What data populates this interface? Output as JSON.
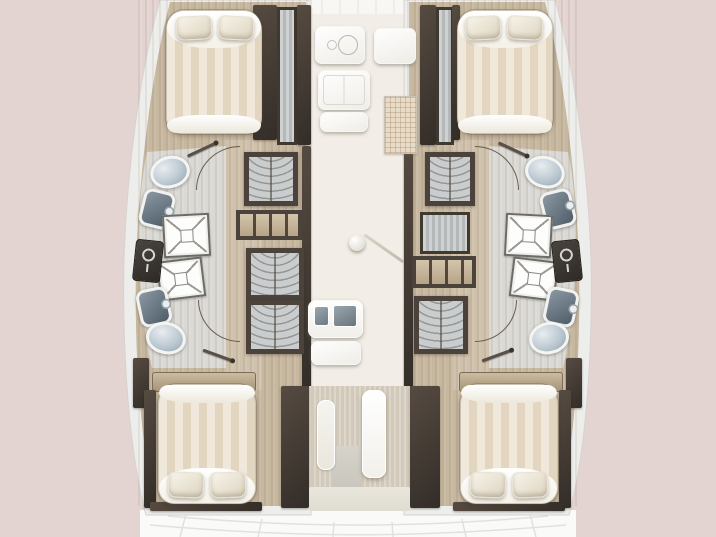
{
  "title": "Catamaran 4-cabin interior layout floor plan (top view)",
  "canvas": {
    "width": 716,
    "height": 537,
    "background": "#e3d4d2"
  },
  "palette": {
    "background": "#e3d4d2",
    "hull_rim": "#edeeec",
    "hull_floor": "#c6b79f",
    "corridor_floor": "#cfc2ac",
    "bathroom_floor": "#dad9d5",
    "saloon_floor": "#f2eee7",
    "cockpit": "#fafaf8",
    "dark_wall": "#463e37",
    "wood_trim": "#b49e83",
    "bed_stripe_a": "#f0e8da",
    "bed_stripe_b": "#e2d6c1",
    "ceramic_blue": "#a7b8c4",
    "basin_slate": "#5c6b77",
    "mat": "#e8dcc8"
  },
  "rooms": [
    {
      "n": "port-forward-cabin",
      "x": 140,
      "y": 0,
      "w": 170,
      "h": 146
    },
    {
      "n": "port-bathroom",
      "x": 128,
      "y": 146,
      "w": 110,
      "h": 222
    },
    {
      "n": "port-aft-cabin",
      "x": 138,
      "y": 368,
      "w": 176,
      "h": 142
    },
    {
      "n": "starboard-forward-cabin",
      "x": 405,
      "y": 0,
      "w": 170,
      "h": 146
    },
    {
      "n": "starboard-bathroom",
      "x": 478,
      "y": 146,
      "w": 110,
      "h": 222
    },
    {
      "n": "starboard-aft-cabin",
      "x": 400,
      "y": 368,
      "w": 176,
      "h": 142
    },
    {
      "n": "saloon-galley",
      "x": 306,
      "y": 0,
      "w": 103,
      "h": 386
    },
    {
      "n": "companionway",
      "x": 281,
      "y": 386,
      "w": 159,
      "h": 126
    },
    {
      "n": "cockpit",
      "x": 140,
      "y": 510,
      "w": 436,
      "h": 27
    }
  ],
  "fixtures": [
    {
      "t": "grain",
      "n": "port-floor-grain",
      "x": 138,
      "y": 0,
      "w": 170,
      "h": 506
    },
    {
      "t": "grain",
      "n": "stbd-floor-grain",
      "x": 407,
      "y": 0,
      "w": 170,
      "h": 506
    },
    {
      "t": "dark-panel",
      "n": "port-fwd-inner-wall",
      "x": 253,
      "y": 5,
      "w": 24,
      "h": 135
    },
    {
      "t": "locker-stripes",
      "n": "port-fwd-hanging-locker",
      "x": 277,
      "y": 7,
      "w": 20,
      "h": 138
    },
    {
      "t": "dark-panel",
      "n": "port-saloon-partition",
      "x": 297,
      "y": 5,
      "w": 14,
      "h": 140
    },
    {
      "t": "dark-panel",
      "n": "stbd-saloon-partition",
      "x": 420,
      "y": 5,
      "w": 16,
      "h": 140
    },
    {
      "t": "locker-stripes",
      "n": "stbd-fwd-hanging-locker",
      "x": 436,
      "y": 7,
      "w": 18,
      "h": 138
    },
    {
      "t": "dark-panel",
      "n": "stbd-fwd-inner-wall",
      "x": 452,
      "y": 5,
      "w": 8,
      "h": 135
    },
    {
      "t": "dark-panel",
      "n": "port-mid-partition",
      "x": 302,
      "y": 146,
      "w": 9,
      "h": 246
    },
    {
      "t": "dark-panel",
      "n": "stbd-mid-partition",
      "x": 404,
      "y": 146,
      "w": 9,
      "h": 246
    },
    {
      "t": "wardrobe",
      "n": "port-fwd-wardrobe",
      "x": 244,
      "y": 152,
      "w": 54,
      "h": 54
    },
    {
      "t": "shelves",
      "n": "port-shelf-unit",
      "x": 236,
      "y": 210,
      "w": 66,
      "h": 30
    },
    {
      "t": "wardrobe",
      "n": "port-mid-wardrobe",
      "x": 246,
      "y": 248,
      "w": 58,
      "h": 52
    },
    {
      "t": "wardrobe",
      "n": "port-aft-wardrobe",
      "x": 246,
      "y": 300,
      "w": 58,
      "h": 54
    },
    {
      "t": "wardrobe",
      "n": "stbd-fwd-wardrobe",
      "x": 425,
      "y": 152,
      "w": 50,
      "h": 54
    },
    {
      "t": "locker-stripes",
      "n": "stbd-mid-locker",
      "x": 420,
      "y": 212,
      "w": 50,
      "h": 42
    },
    {
      "t": "shelves",
      "n": "stbd-shelf-unit",
      "x": 412,
      "y": 256,
      "w": 64,
      "h": 32
    },
    {
      "t": "wardrobe",
      "n": "stbd-aft-wardrobe",
      "x": 414,
      "y": 296,
      "w": 54,
      "h": 58
    },
    {
      "t": "dark-panel",
      "n": "port-aft-outboard-wall",
      "x": 133,
      "y": 358,
      "w": 16,
      "h": 50
    },
    {
      "t": "dark-panel",
      "n": "stbd-aft-outboard-wall",
      "x": 566,
      "y": 358,
      "w": 16,
      "h": 50
    },
    {
      "t": "wood-panel",
      "n": "port-aft-headboard",
      "x": 152,
      "y": 372,
      "w": 104,
      "h": 20
    },
    {
      "t": "wood-panel",
      "n": "stbd-aft-headboard",
      "x": 459,
      "y": 372,
      "w": 104,
      "h": 20
    },
    {
      "t": "dark-panel",
      "n": "port-aft-sidewall",
      "x": 144,
      "y": 390,
      "w": 12,
      "h": 118
    },
    {
      "t": "dark-panel",
      "n": "stbd-aft-sidewall",
      "x": 559,
      "y": 390,
      "w": 12,
      "h": 118
    },
    {
      "t": "dark-panel",
      "n": "port-aft-footwall",
      "x": 150,
      "y": 502,
      "w": 112,
      "h": 9
    },
    {
      "t": "dark-panel",
      "n": "stbd-aft-footwall",
      "x": 453,
      "y": 502,
      "w": 112,
      "h": 9
    },
    {
      "t": "floor-beige",
      "n": "companionway-floor",
      "x": 309,
      "y": 386,
      "w": 101,
      "h": 124
    },
    {
      "t": "dark-panel",
      "n": "companionway-port-cabinet",
      "x": 281,
      "y": 386,
      "w": 28,
      "h": 122
    },
    {
      "t": "dark-panel",
      "n": "companionway-stbd-cabinet",
      "x": 410,
      "y": 386,
      "w": 30,
      "h": 122
    },
    {
      "t": "panel-gray",
      "n": "companionway-shadow",
      "x": 332,
      "y": 446,
      "w": 30,
      "h": 62
    },
    {
      "t": "slab",
      "n": "companionway-step-low",
      "x": 317,
      "y": 400,
      "w": 18,
      "h": 70
    },
    {
      "t": "slab-white",
      "n": "companionway-step-high",
      "x": 362,
      "y": 390,
      "w": 24,
      "h": 88
    },
    {
      "t": "panel-light2",
      "n": "cockpit-sill",
      "x": 309,
      "y": 487,
      "w": 101,
      "h": 24
    },
    {
      "t": "stove",
      "n": "galley-stove",
      "x": 315,
      "y": 26,
      "w": 50,
      "h": 38
    },
    {
      "t": "counter-split",
      "n": "galley-fridge",
      "x": 318,
      "y": 70,
      "w": 52,
      "h": 40
    },
    {
      "t": "counter",
      "n": "galley-counter-fwd",
      "x": 320,
      "y": 112,
      "w": 48,
      "h": 20
    },
    {
      "t": "counter",
      "n": "nav-counter",
      "x": 374,
      "y": 28,
      "w": 42,
      "h": 36
    },
    {
      "t": "grid-mat",
      "n": "saloon-mat",
      "x": 384,
      "y": 96,
      "w": 33,
      "h": 58
    },
    {
      "t": "galley-sink",
      "n": "galley-sink",
      "x": 308,
      "y": 300,
      "w": 55,
      "h": 38
    },
    {
      "t": "counter",
      "n": "galley-counter-aft",
      "x": 311,
      "y": 341,
      "w": 50,
      "h": 24
    },
    {
      "t": "mast",
      "n": "compression-post",
      "x": 349,
      "y": 235,
      "w": 16,
      "h": 16
    },
    {
      "t": "mast-line",
      "n": "track-line",
      "x": 360,
      "y": 247,
      "w": 48,
      "h": 3,
      "r": 35
    },
    {
      "t": "toilet",
      "n": "port-fwd-toilet",
      "x": 150,
      "y": 156,
      "w": 40,
      "h": 32,
      "r": -15
    },
    {
      "t": "sink",
      "n": "port-fwd-sink",
      "x": 141,
      "y": 190,
      "w": 32,
      "h": 38,
      "r": 14
    },
    {
      "t": "shower",
      "n": "port-fwd-shower",
      "x": 163,
      "y": 214,
      "w": 47,
      "h": 43,
      "r": -3
    },
    {
      "t": "shower",
      "n": "port-aft-shower",
      "x": 158,
      "y": 259,
      "w": 46,
      "h": 40,
      "r": -7
    },
    {
      "t": "tech",
      "n": "port-tech-unit",
      "x": 134,
      "y": 240,
      "w": 28,
      "h": 42,
      "r": 6
    },
    {
      "t": "sink",
      "n": "port-aft-sink",
      "x": 138,
      "y": 288,
      "w": 32,
      "h": 38,
      "r": -12
    },
    {
      "t": "toilet",
      "n": "port-aft-toilet",
      "x": 146,
      "y": 322,
      "w": 40,
      "h": 32,
      "r": 12
    },
    {
      "t": "toilet",
      "n": "stbd-fwd-toilet",
      "x": 525,
      "y": 156,
      "w": 40,
      "h": 32,
      "r": 15
    },
    {
      "t": "sink",
      "n": "stbd-fwd-sink",
      "x": 542,
      "y": 190,
      "w": 32,
      "h": 38,
      "r": -14
    },
    {
      "t": "shower",
      "n": "stbd-fwd-shower",
      "x": 505,
      "y": 214,
      "w": 47,
      "h": 43,
      "r": 3
    },
    {
      "t": "shower",
      "n": "stbd-aft-shower",
      "x": 511,
      "y": 259,
      "w": 46,
      "h": 40,
      "r": 7
    },
    {
      "t": "tech",
      "n": "stbd-tech-unit",
      "x": 553,
      "y": 240,
      "w": 28,
      "h": 42,
      "r": -6
    },
    {
      "t": "sink",
      "n": "stbd-aft-sink",
      "x": 545,
      "y": 288,
      "w": 32,
      "h": 38,
      "r": 12
    },
    {
      "t": "toilet",
      "n": "stbd-aft-toilet",
      "x": 529,
      "y": 322,
      "w": 40,
      "h": 32,
      "r": -12
    },
    {
      "t": "bed",
      "n": "port-fwd-berth",
      "x": 166,
      "y": 10,
      "w": 96,
      "h": 124,
      "o": "n"
    },
    {
      "t": "pillow",
      "n": "port-fwd-pillow-a",
      "x": 176,
      "y": 16,
      "w": 36,
      "h": 24,
      "r": -3
    },
    {
      "t": "pillow",
      "n": "port-fwd-pillow-b",
      "x": 218,
      "y": 16,
      "w": 36,
      "h": 24,
      "r": 3
    },
    {
      "t": "bed",
      "n": "stbd-fwd-berth",
      "x": 457,
      "y": 10,
      "w": 96,
      "h": 124,
      "o": "n"
    },
    {
      "t": "pillow",
      "n": "stbd-fwd-pillow-a",
      "x": 465,
      "y": 16,
      "w": 36,
      "h": 24,
      "r": -3
    },
    {
      "t": "pillow",
      "n": "stbd-fwd-pillow-b",
      "x": 507,
      "y": 16,
      "w": 36,
      "h": 24,
      "r": 3
    },
    {
      "t": "bed",
      "n": "port-aft-berth",
      "x": 158,
      "y": 384,
      "w": 98,
      "h": 120,
      "o": "s"
    },
    {
      "t": "pillow",
      "n": "port-aft-pillow-a",
      "x": 168,
      "y": 472,
      "w": 36,
      "h": 26,
      "r": 2
    },
    {
      "t": "pillow",
      "n": "port-aft-pillow-b",
      "x": 210,
      "y": 472,
      "w": 36,
      "h": 26,
      "r": -2
    },
    {
      "t": "bed",
      "n": "stbd-aft-berth",
      "x": 460,
      "y": 384,
      "w": 98,
      "h": 120,
      "o": "s"
    },
    {
      "t": "pillow",
      "n": "stbd-aft-pillow-a",
      "x": 470,
      "y": 472,
      "w": 36,
      "h": 26,
      "r": 2
    },
    {
      "t": "pillow",
      "n": "stbd-aft-pillow-b",
      "x": 512,
      "y": 472,
      "w": 36,
      "h": 26,
      "r": -2
    },
    {
      "t": "door-arc",
      "n": "port-fwd-bath-door-arc",
      "x": 196,
      "y": 146,
      "w": 88,
      "h": 88,
      "q": "tl"
    },
    {
      "t": "door-leaf",
      "n": "port-fwd-bath-door",
      "x": 186,
      "y": 148,
      "w": 32,
      "h": 3,
      "r": -25
    },
    {
      "t": "door-arc",
      "n": "port-aft-cabin-door-arc",
      "x": 198,
      "y": 258,
      "w": 84,
      "h": 84,
      "q": "bl"
    },
    {
      "t": "door-leaf",
      "n": "port-aft-cabin-door",
      "x": 202,
      "y": 354,
      "w": 32,
      "h": 3,
      "r": 20
    },
    {
      "t": "door-arc",
      "n": "stbd-fwd-bath-door-arc",
      "x": 431,
      "y": 146,
      "w": 88,
      "h": 88,
      "q": "tr"
    },
    {
      "t": "door-leaf",
      "n": "stbd-fwd-bath-door",
      "x": 497,
      "y": 148,
      "w": 32,
      "h": 3,
      "r": 25
    },
    {
      "t": "door-arc",
      "n": "stbd-aft-cabin-door-arc",
      "x": 433,
      "y": 258,
      "w": 84,
      "h": 84,
      "q": "br"
    },
    {
      "t": "door-leaf",
      "n": "stbd-aft-cabin-door",
      "x": 481,
      "y": 354,
      "w": 32,
      "h": 3,
      "r": -20
    }
  ]
}
